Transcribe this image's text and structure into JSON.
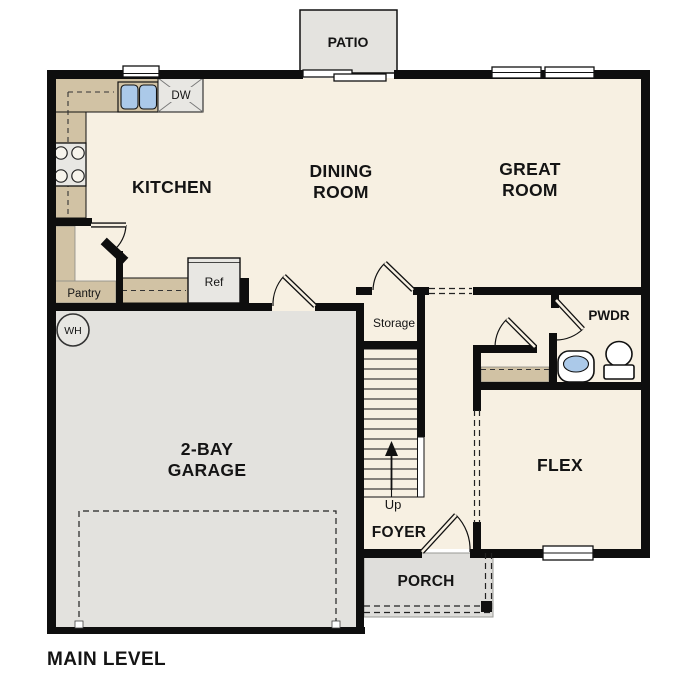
{
  "title": "MAIN LEVEL",
  "rooms": {
    "kitchen": "KITCHEN",
    "dining": [
      "DINING",
      "ROOM"
    ],
    "great": [
      "GREAT",
      "ROOM"
    ],
    "garage": [
      "2-BAY",
      "GARAGE"
    ],
    "flex": "FLEX",
    "foyer": "FOYER",
    "porch": "PORCH",
    "patio": "PATIO",
    "powder": "PWDR"
  },
  "features": {
    "pantry": "Pantry",
    "storage": "Storage",
    "stairs_up": "Up",
    "refrigerator": "Ref",
    "dishwasher": "DW",
    "water_heater": "WH"
  },
  "colors": {
    "wall": "#0e0e0e",
    "floor": "#f7f0e2",
    "garage": "#e3e2de",
    "patio": "#e4e3df",
    "porch": "#dfdedb",
    "counter": "#d1c2a4",
    "water": "#abc9e9",
    "appliance": "#e8e7e3",
    "text": "#141414"
  }
}
